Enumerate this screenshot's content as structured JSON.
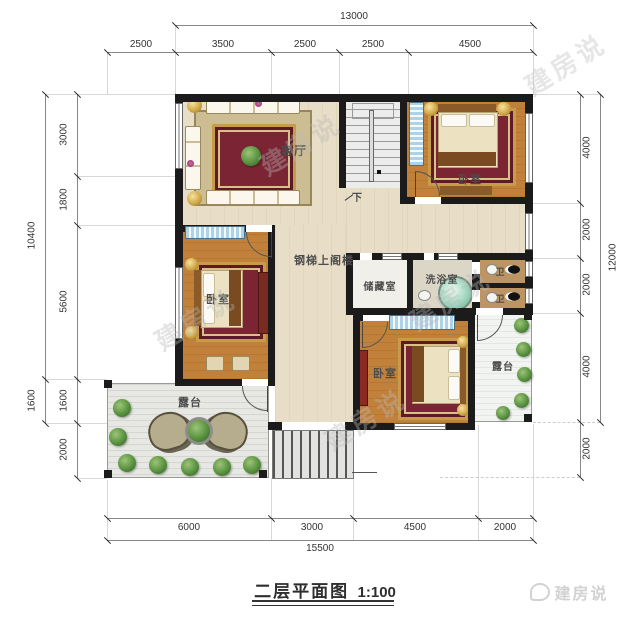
{
  "title": {
    "text": "二层平面图",
    "scale": "1:100"
  },
  "logo": {
    "text": "建房说"
  },
  "watermark": {
    "text": "建房说"
  },
  "rooms": {
    "living": "客厅",
    "bedroom": "卧室",
    "storage": "储藏室",
    "bath": "洗浴室",
    "wc": "卫",
    "terrace": "露台",
    "stair_note": "钢梯上阁楼",
    "down": "下"
  },
  "dimensions": {
    "top_total": "13000",
    "top": [
      "2500",
      "3500",
      "2500",
      "2500",
      "4500"
    ],
    "left_outer": [
      "10400",
      "1600"
    ],
    "left": [
      "3000",
      "1800",
      "5600",
      "1600",
      "2000"
    ],
    "right": [
      "4000",
      "2000",
      "2000",
      "4000",
      "2000"
    ],
    "right_outer": "12000",
    "bottom": [
      "6000",
      "3000",
      "4500",
      "2000"
    ],
    "bottom_total": "15500"
  },
  "colors": {
    "wall": "#1b1b1b",
    "wood_floor": "#c2813a",
    "hall_floor": "#e8ddc6",
    "window_blue": "#aed2e6",
    "plant_green": "#58923f",
    "tub_teal": "#9fd8bf",
    "rug_red": "#7b2434",
    "deck": "#e7e8e4"
  }
}
